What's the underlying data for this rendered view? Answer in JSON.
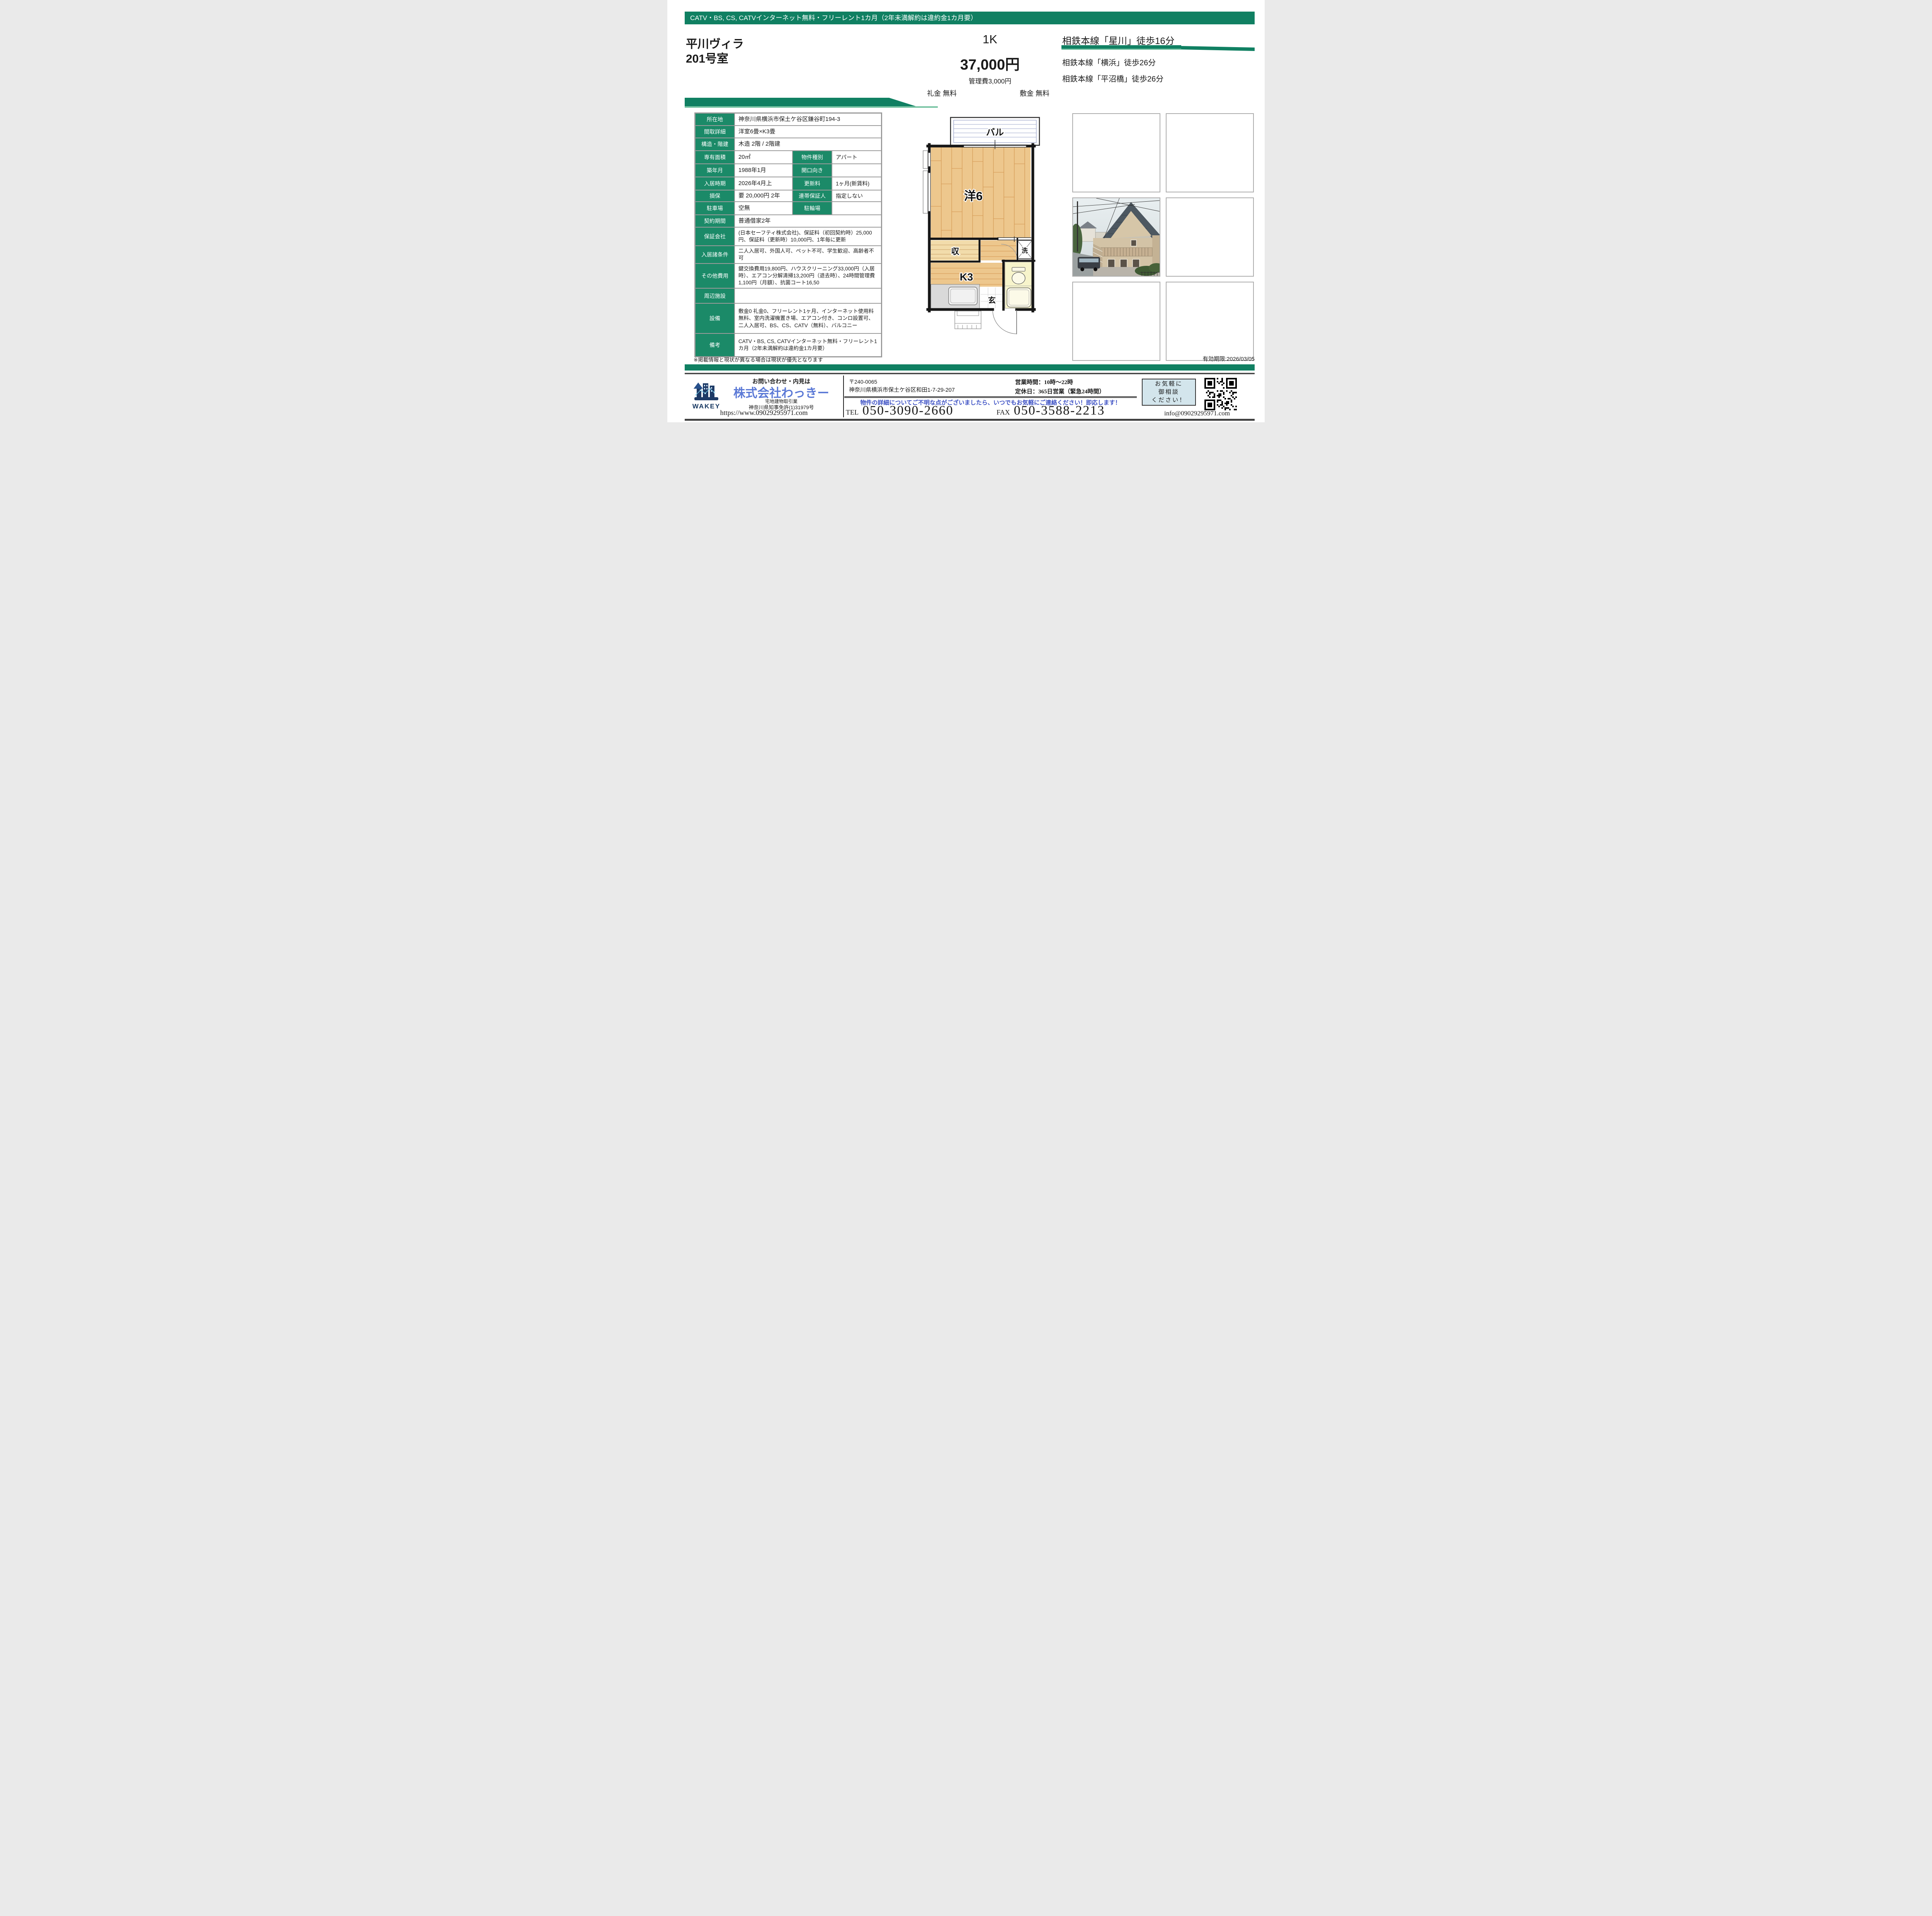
{
  "colors": {
    "green": "#108062",
    "green_light": "#79c4a4",
    "label_green": "#1b8a68",
    "promo_blue": "#3b4fc4",
    "company_blue": "#5b79d6",
    "consult_bg": "#d3e5ec",
    "logo_navy": "#1d3a66"
  },
  "banner": {
    "text": "CATV・BS, CS, CATVインターネット無料・フリーレント1カ月（2年未満解約は違約金1カ月要）"
  },
  "property": {
    "name_line1": "平川ヴィラ",
    "name_line2": "201号室"
  },
  "price": {
    "layout": "1K",
    "rent": "37,000円",
    "management_fee": "管理費3,000円",
    "reikin": "礼金 無料",
    "shikikin": "敷金 無料"
  },
  "access": {
    "primary": "相鉄本線「星川」徒歩16分",
    "others": [
      "相鉄本線「横浜」徒歩26分",
      "相鉄本線「平沼橋」徒歩26分"
    ]
  },
  "table": {
    "rows": [
      {
        "label": "所在地",
        "value": "神奈川県横浜市保土ケ谷区鎌谷町194-3",
        "h": 30
      },
      {
        "label": "間取詳細",
        "value": "洋室6畳×K3畳",
        "h": 30
      },
      {
        "label": "構造・階建",
        "value": "木造 2階 / 2階建",
        "h": 31
      },
      {
        "label": "専有面積",
        "value": "20㎡",
        "label2": "物件種別",
        "value2": "アパート",
        "h": 32
      },
      {
        "label": "築年月",
        "value": "1988年1月",
        "label2": "開口向き",
        "value2": "",
        "h": 32
      },
      {
        "label": "入居時期",
        "value": "2026年4月上",
        "label2": "更新料",
        "value2": "1ヶ月(新賃料)",
        "h": 32
      },
      {
        "label": "損保",
        "value": "要 20,000円 2年",
        "label2": "連帯保証人",
        "value2": "指定しない",
        "h": 28
      },
      {
        "label": "駐車場",
        "value": "空無",
        "label2": "駐輪場",
        "value2": "",
        "h": 32
      },
      {
        "label": "契約期間",
        "value": "普通借家2年",
        "h": 30
      },
      {
        "label": "保証会社",
        "value": "(日本セーフティ株式会社)、保証料（初回契約時）25,000円、保証料（更新時）10,000円、1年毎に更新",
        "h": 46,
        "small": true
      },
      {
        "label": "入居諸条件",
        "value": "二人入居可、外国人可、ペット不可、学生歓迎、高齢者不可",
        "h": 39,
        "small": true
      },
      {
        "label": "その他費用",
        "value": "鍵交換費用19,800円、ハウスクリーニング33,000円（入居時）、エアコン分解清掃13,200円（退去時）、24時間管理費1,100円（月額）、抗菌コート16,50",
        "h": 56,
        "small": true
      },
      {
        "label": "周辺施設",
        "value": "",
        "h": 37
      },
      {
        "label": "設備",
        "value": "敷金0 礼金0、フリーレント1ヶ月、インターネット使用料無料、室内洗濯機置き場、エアコン付き、コンロ設置可、二人入居可、BS、CS、CATV（無料）、バルコニー",
        "h": 76,
        "small": true
      },
      {
        "label": "備考",
        "value": "CATV・BS, CS, CATVインターネット無料・フリーレント1カ月（2年未満解約は違約金1カ月要）",
        "h": 58,
        "small": true
      }
    ]
  },
  "floor_plan": {
    "balcony": "バル",
    "room": "洋6",
    "closet": "収",
    "kitchen": "K3",
    "entrance": "玄",
    "washer": "洗"
  },
  "note": "※掲載情報と現状が異なる場合は現状が優先となります",
  "expiry": "有効期限:2026/03/05",
  "footer": {
    "inquiry_label": "お問い合わせ・内見は",
    "company_name": "株式会社わっきー",
    "logo_text": "WAKEY",
    "license_line1": "宅地建物取引業",
    "license_line2": "神奈川県知事免許(1)31979号",
    "url": "https://www.09029295971.com",
    "postal": "〒240-0065",
    "address": "神奈川県横浜市保土ケ谷区和田1-7-29-207",
    "hours": "営業時間：10時～22時",
    "closed": "定休日：365日営業（緊急24時間）",
    "promo": "物件の詳細についてご不明な点がございましたら、いつでもお気軽にご連絡ください！即応します！",
    "tel_label": "TEL",
    "tel_number": "050-3090-2660",
    "fax_label": "FAX",
    "fax_number": "050-3588-2213",
    "consult_line1": "お気軽に",
    "consult_line2": "御相談",
    "consult_line3": "ください！",
    "email": "info@09029295971.com"
  }
}
